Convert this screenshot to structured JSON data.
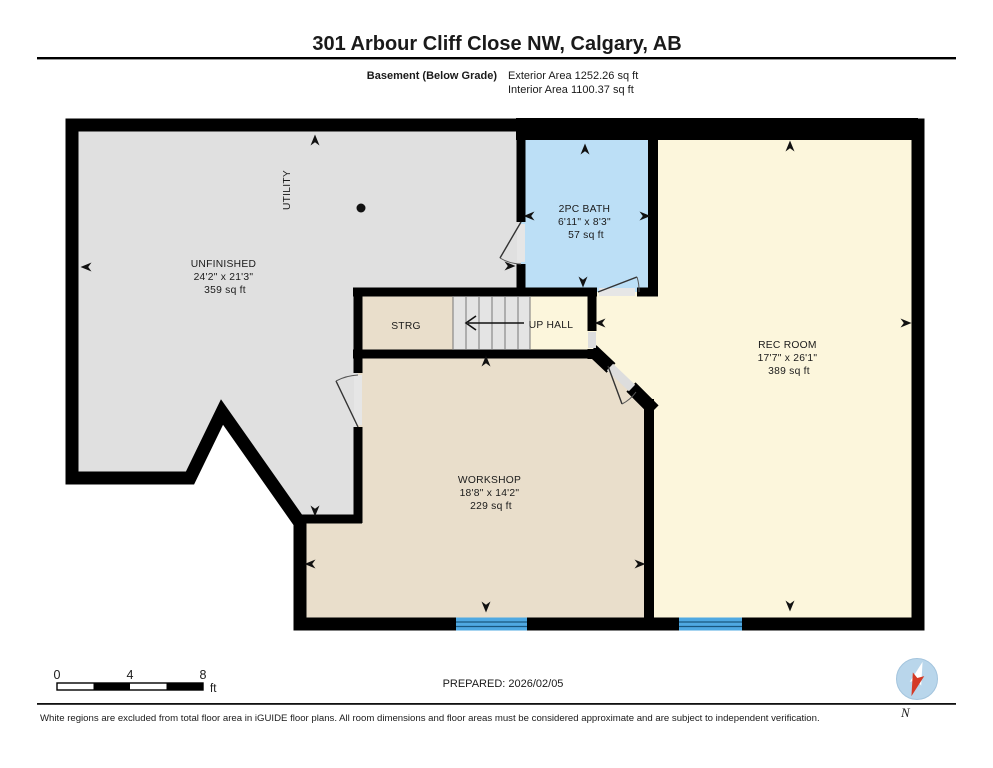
{
  "header": {
    "title": "301 Arbour Cliff Close NW, Calgary, AB",
    "floor_label": "Basement (Below Grade)",
    "exterior_area": "Exterior Area 1252.26 sq ft",
    "interior_area": "Interior Area 1100.37 sq ft"
  },
  "rooms": {
    "unfinished": {
      "name": "UNFINISHED",
      "dims": "24'2\" x 21'3\"",
      "area": "359 sq ft"
    },
    "utility": {
      "name": "UTILITY"
    },
    "bath": {
      "name": "2PC BATH",
      "dims": "6'11\" x 8'3\"",
      "area": "57 sq ft"
    },
    "rec_room": {
      "name": "REC ROOM",
      "dims": "17'7\" x 26'1\"",
      "area": "389 sq ft"
    },
    "workshop": {
      "name": "WORKSHOP",
      "dims": "18'8\" x 14'2\"",
      "area": "229 sq ft"
    },
    "strg": {
      "name": "STRG"
    },
    "up_hall": {
      "name": "UP HALL"
    }
  },
  "scale_bar": {
    "ticks": [
      "0",
      "4",
      "8"
    ],
    "unit": "ft"
  },
  "footer": {
    "prepared": "PREPARED: 2026/02/05",
    "disclaimer": "White regions are excluded from total floor area in iGUIDE floor plans. All room dimensions and floor areas must be considered approximate and are subject to independent verification.",
    "compass_label": "N"
  },
  "colors": {
    "wall": "#000000",
    "unfinished_gray": "#E0E0E0",
    "stairs_gray": "#E4E4E4",
    "bath_blue": "#BCDFF6",
    "cream": "#FCF6DC",
    "tan": "#E9DECB",
    "window_blue": "#4FA9E2",
    "compass_blue": "#B9D6EB",
    "needle_red": "#D43A26"
  }
}
